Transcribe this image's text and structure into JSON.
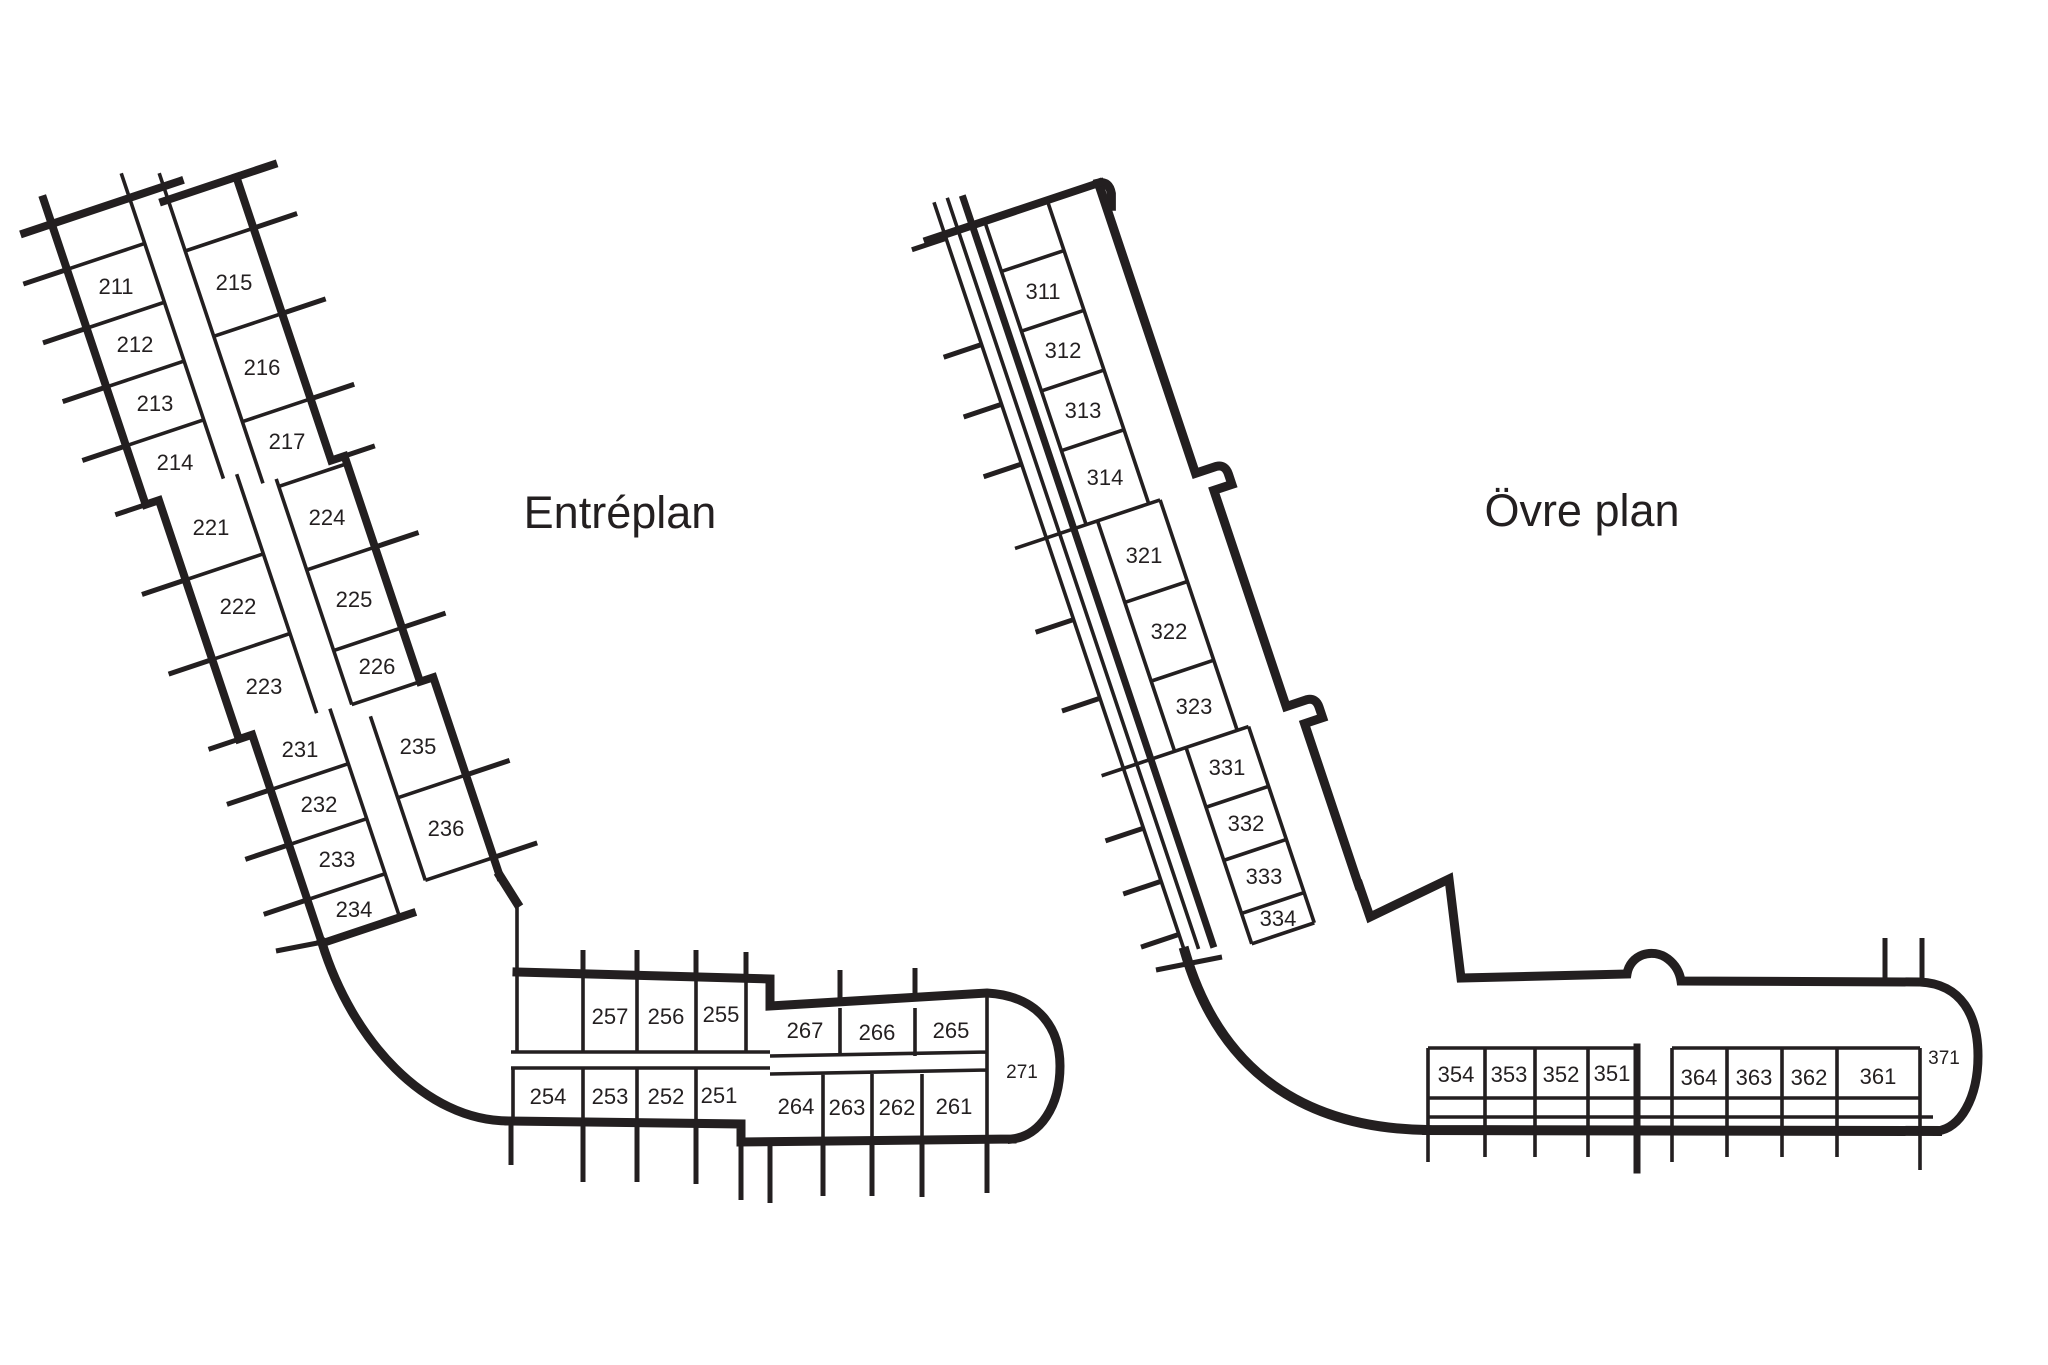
{
  "document": {
    "type": "floor-plan-drawing",
    "language": "sv"
  },
  "colors": {
    "ink": "#231f20",
    "background": "#ffffff"
  },
  "plans": {
    "entreplan": {
      "title": "Entréplan",
      "rooms": {
        "211": "211",
        "212": "212",
        "213": "213",
        "214": "214",
        "215": "215",
        "216": "216",
        "217": "217",
        "221": "221",
        "222": "222",
        "223": "223",
        "224": "224",
        "225": "225",
        "226": "226",
        "231": "231",
        "232": "232",
        "233": "233",
        "234": "234",
        "235": "235",
        "236": "236",
        "251": "251",
        "252": "252",
        "253": "253",
        "254": "254",
        "255": "255",
        "256": "256",
        "257": "257",
        "261": "261",
        "262": "262",
        "263": "263",
        "264": "264",
        "265": "265",
        "266": "266",
        "267": "267",
        "271": "271"
      }
    },
    "ovreplan": {
      "title": "Övre plan",
      "rooms": {
        "311": "311",
        "312": "312",
        "313": "313",
        "314": "314",
        "321": "321",
        "322": "322",
        "323": "323",
        "331": "331",
        "332": "332",
        "333": "333",
        "334": "334",
        "351": "351",
        "352": "352",
        "353": "353",
        "354": "354",
        "361": "361",
        "362": "362",
        "363": "363",
        "364": "364",
        "371": "371"
      }
    }
  }
}
